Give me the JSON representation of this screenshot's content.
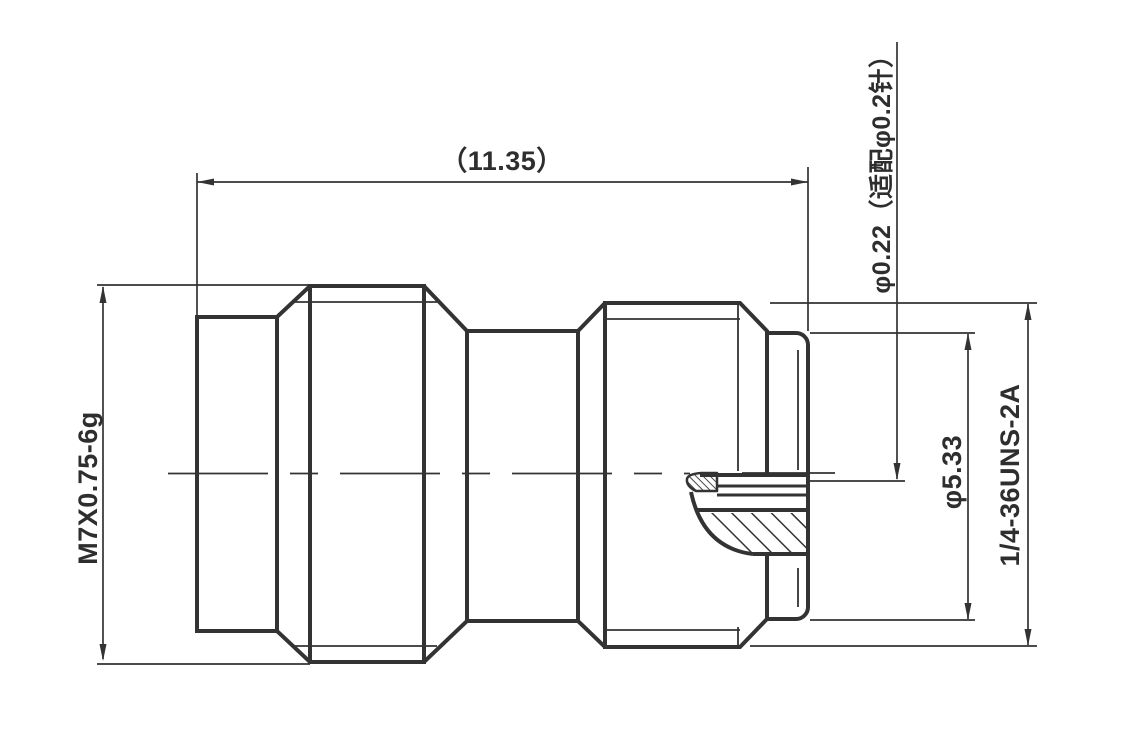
{
  "drawing": {
    "labels": {
      "overall_length": "（11.35）",
      "left_thread": "M7X0.75-6g",
      "pin_dia_note": "φ0.22（适配φ0.2针）",
      "interface_dia": "φ5.33",
      "right_thread": "1/4-36UNS-2A"
    },
    "colors": {
      "line": "#333333",
      "background": "#ffffff"
    }
  }
}
